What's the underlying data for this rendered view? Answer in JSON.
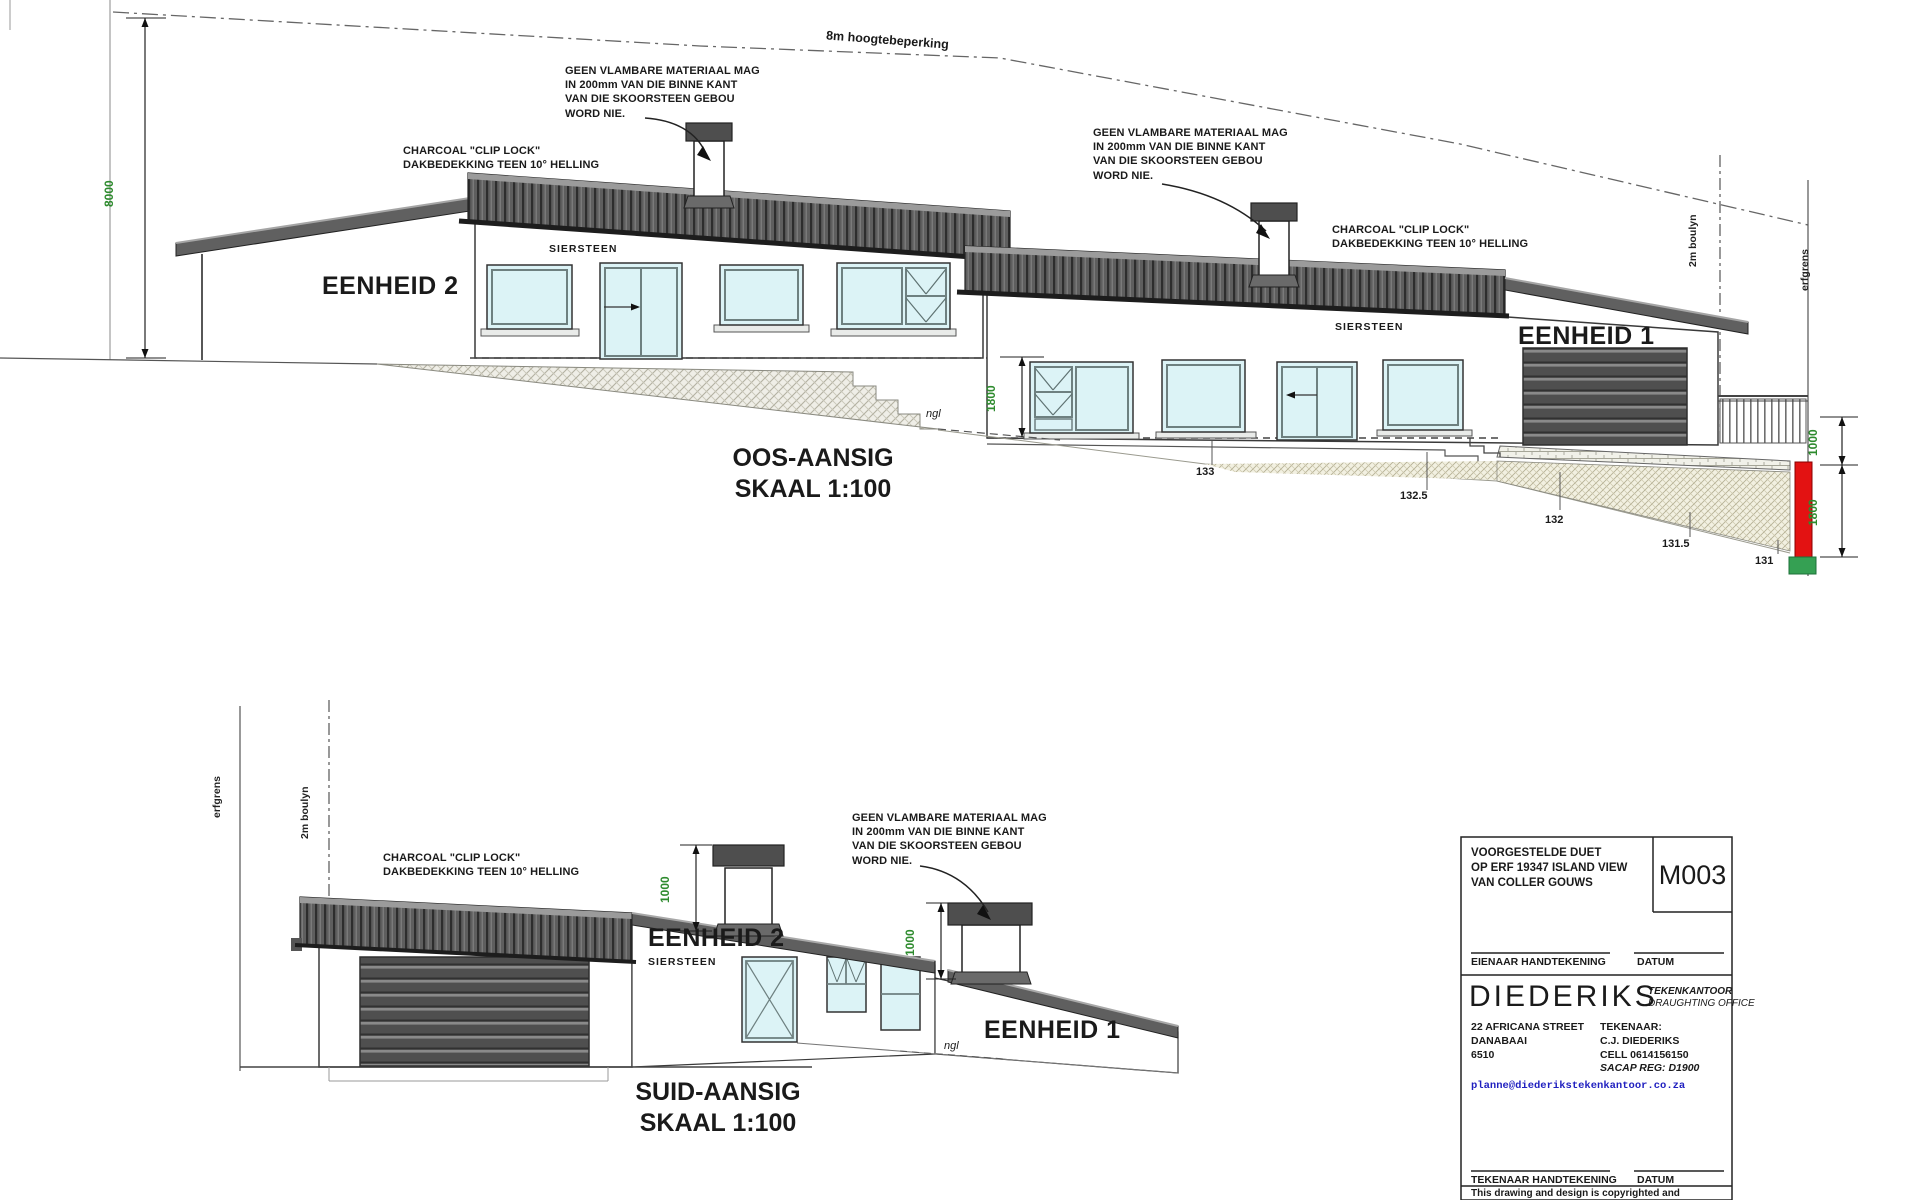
{
  "drawing": {
    "height_restriction_label": "8m hoogtebeperking",
    "boundary_label": "erfgrens",
    "building_line_label": "2m boulyn",
    "natural_ground_label": "ngl",
    "brick_label": "SIERSTEEN",
    "unit1_label": "EENHEID 1",
    "unit2_label": "EENHEID 2",
    "chimney_note": "GEEN VLAMBARE MATERIAAL MAG\nIN 200mm VAN DIE BINNE KANT\nVAN DIE SKOORSTEEN GEBOU\nWORD NIE.",
    "roof_note": "CHARCOAL \"CLIP LOCK\"\nDAKBEDEKKING TEEN 10° HELLING"
  },
  "east_elevation": {
    "title": "OOS-AANSIG",
    "scale": "SKAAL 1:100",
    "dim_total_height": "8000",
    "dim_wall_height": "1800",
    "dim_upper_right": "1000",
    "dim_lower_right": "1800",
    "contour_labels": [
      "133",
      "132.5",
      "132",
      "131.5",
      "131"
    ]
  },
  "south_elevation": {
    "title": "SUID-AANSIG",
    "scale": "SKAAL 1:100",
    "dim_chimney_left": "1000",
    "dim_chimney_right": "1000"
  },
  "title_block": {
    "project_description": "VOORGESTELDE DUET\nOP ERF 19347 ISLAND VIEW\nVAN COLLER GOUWS",
    "drawing_number": "M003",
    "owner_signature_label": "EIENAAR HANDTEKENING",
    "date_label_owner": "DATUM",
    "firm_name": "DIEDERIKS",
    "firm_subtitle_1": "TEKENKANTOOR",
    "firm_subtitle_2": "DRAUGHTING OFFICE",
    "address": "22 AFRICANA STREET\nDANABAAI\n6510",
    "drafter_info": "TEKENAAR:\nC.J. DIEDERIKS\nCELL 0614156150",
    "sacap_reg": "SACAP REG:  D1900",
    "email": "planne@diederikstekenkantoor.co.za",
    "drafter_signature_label": "TEKENAAR HANDTEKENING",
    "date_label_drafter": "DATUM",
    "copyright_note": "This drawing and design is copyrighted and"
  },
  "colors": {
    "dimension_green": "#2e8b2e",
    "marker_red": "#e31212",
    "marker_green": "#35a053",
    "email_blue": "#1f1fbf"
  }
}
